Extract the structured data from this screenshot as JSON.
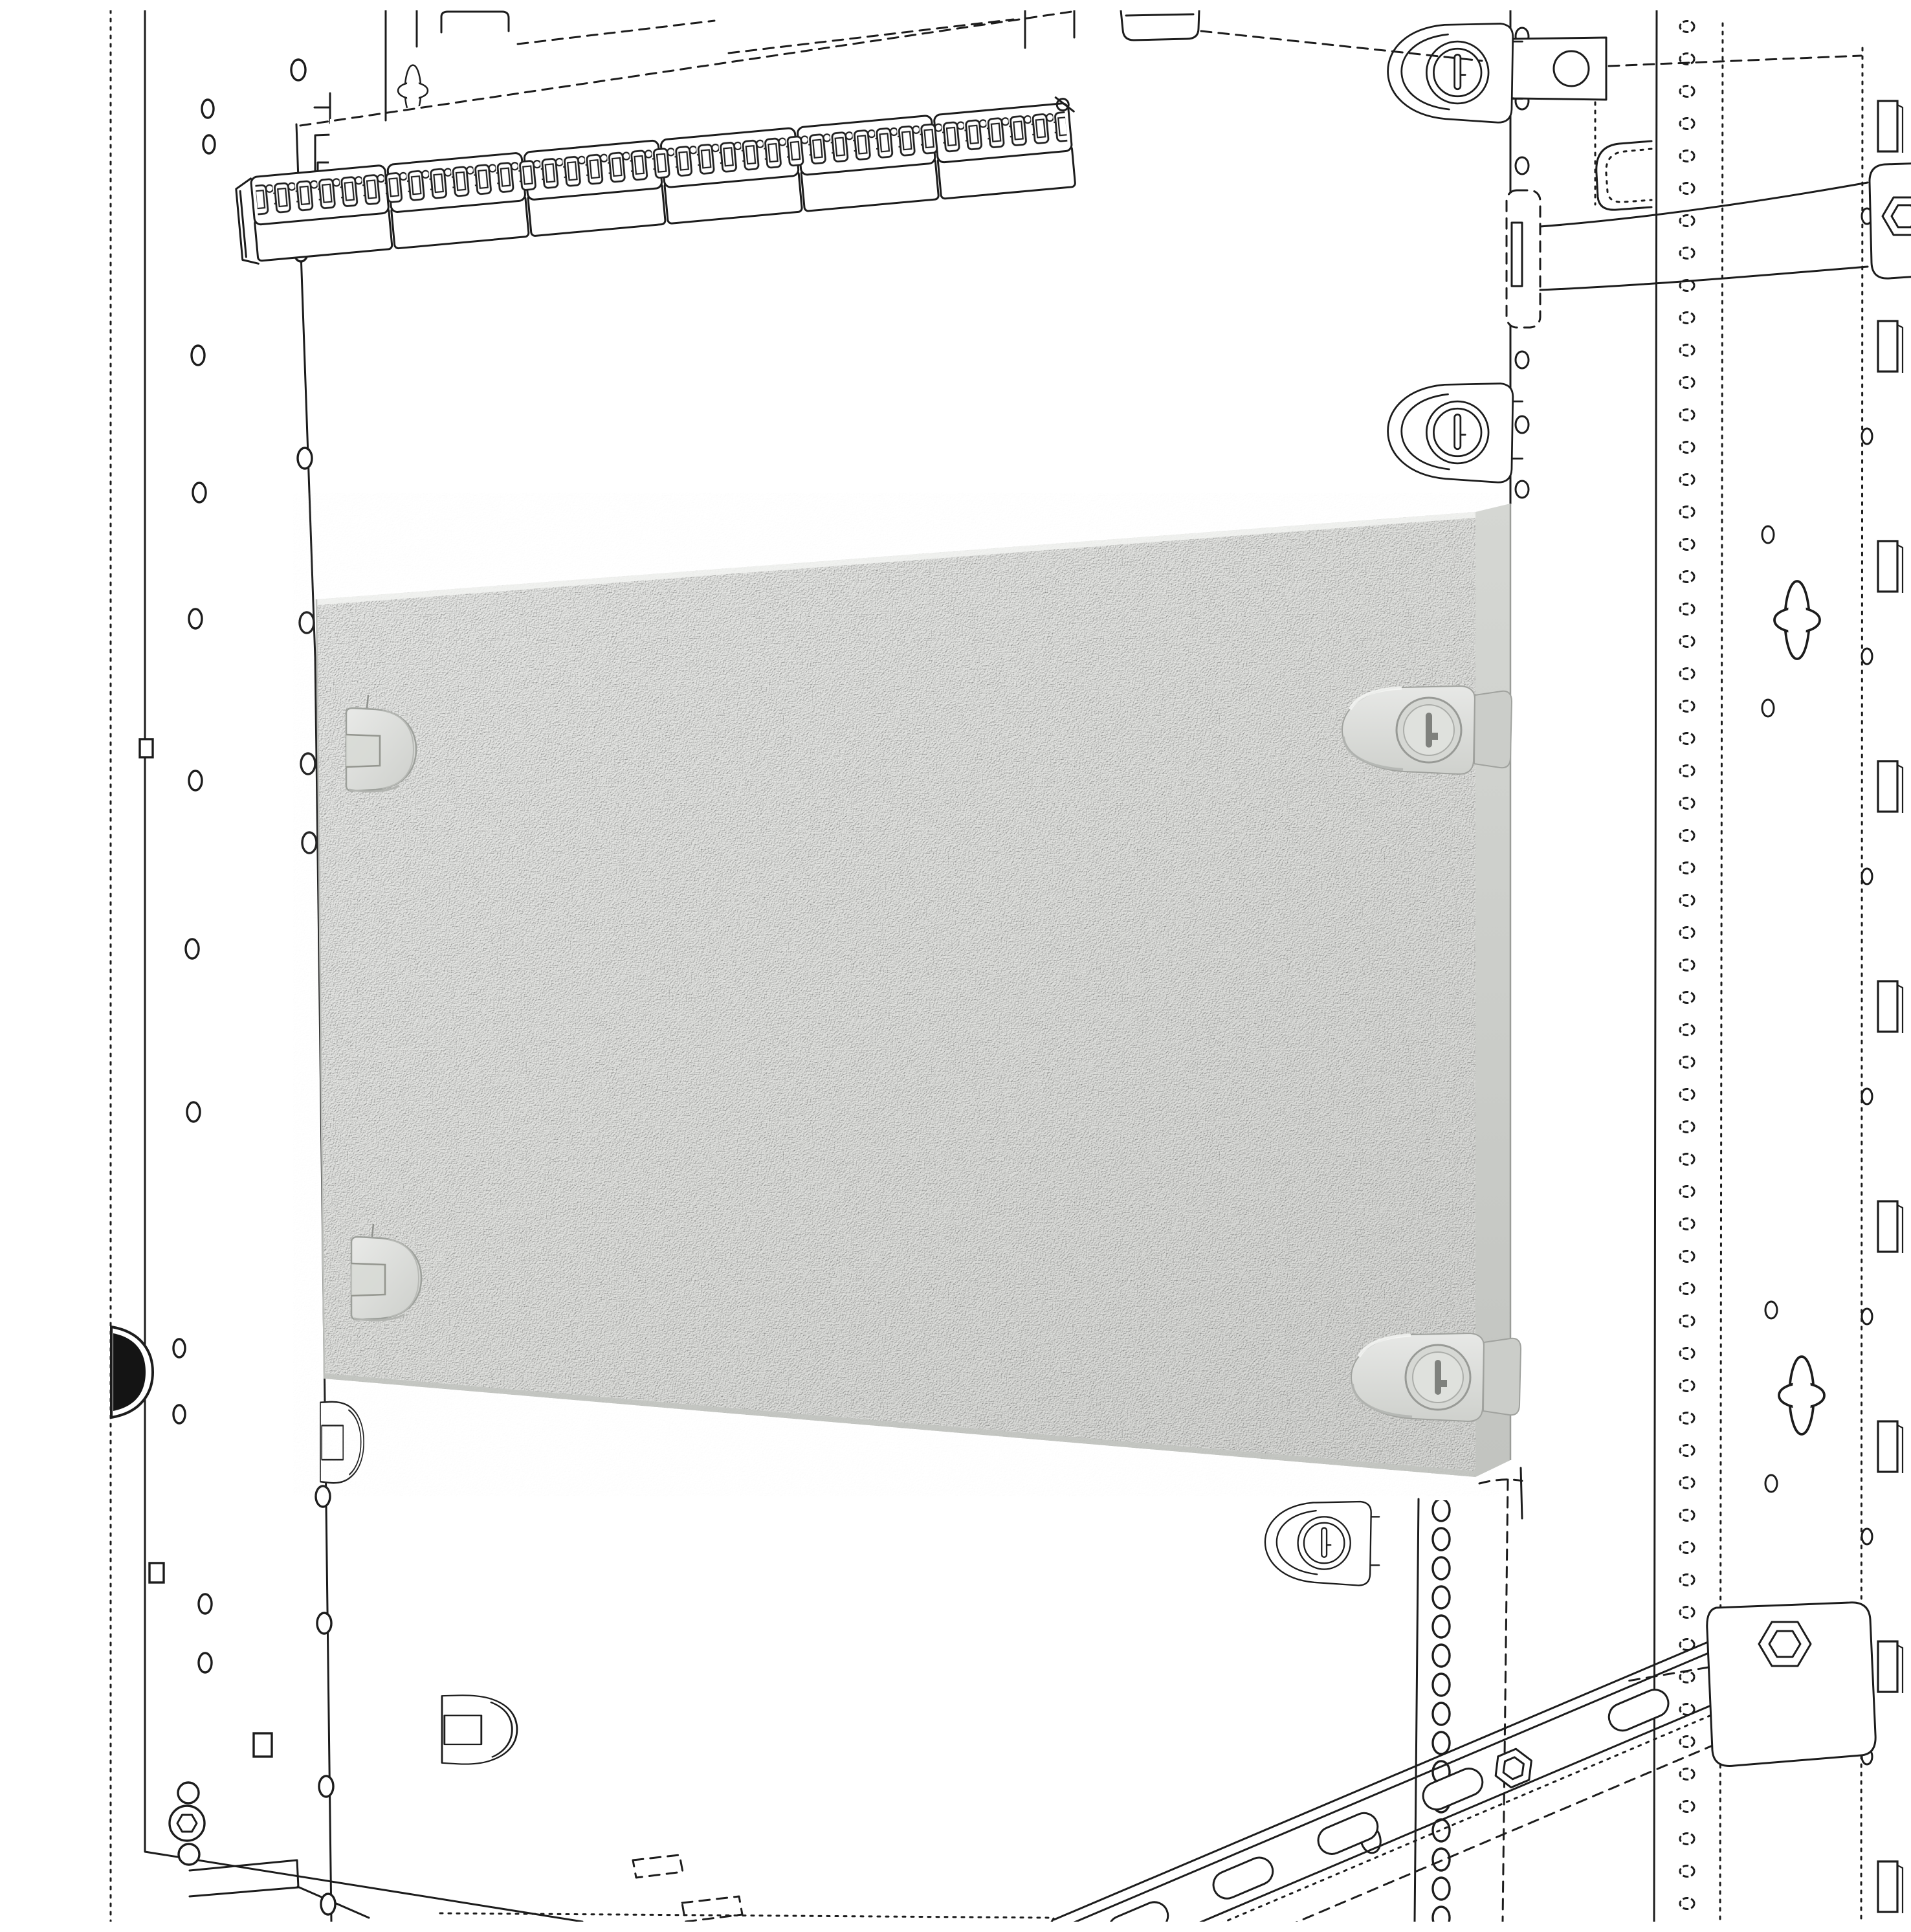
{
  "meta": {
    "domain": "technical-illustration",
    "title": "Enclosure blind front panel with quarter-turn fixings - isometric line drawing",
    "description": "Black-and-white isometric CAD drawing of an electrical cabinet interior: perforated mounting uprights on the left and right, a top mounting plate carrying a six-section DIN terminal strip, and a textured grey blind front panel fixed with two slotted quarter-turn locks on its right edge and two fixing knobs on its left edge. A slotted DIN rail with a fixing bracket and hex bolts runs across the lower right, and the frame rails show rows of round holes, square cage-nut slots and clover-shaped keyholes."
  },
  "drawing": {
    "background": "#ffffff",
    "line_color": "#1c1c1c",
    "panel": {
      "face_color": "#e4e5e2",
      "side_color": "#c9cbc7",
      "texture": "stucco",
      "fixings": [
        "fixing-knob-left-top",
        "fixing-knob-left-bottom",
        "quarter-turn-lock-right-top",
        "quarter-turn-lock-right-bottom"
      ]
    },
    "terminal_strip": {
      "sections": 6,
      "terminals_per_section": 6
    },
    "components": [
      "left-frame-rail",
      "left-side-wall",
      "mounting-upright-left",
      "mounting-tabs",
      "mounting-plate",
      "din-terminal-strip",
      "blind-panel",
      "quarter-turn-locks",
      "latch-bracket",
      "support-arm",
      "perforated-upright-right",
      "cage-nut-rail-right",
      "clover-keyholes",
      "din-rail-bottom",
      "fixing-bracket-bottom-right"
    ]
  }
}
